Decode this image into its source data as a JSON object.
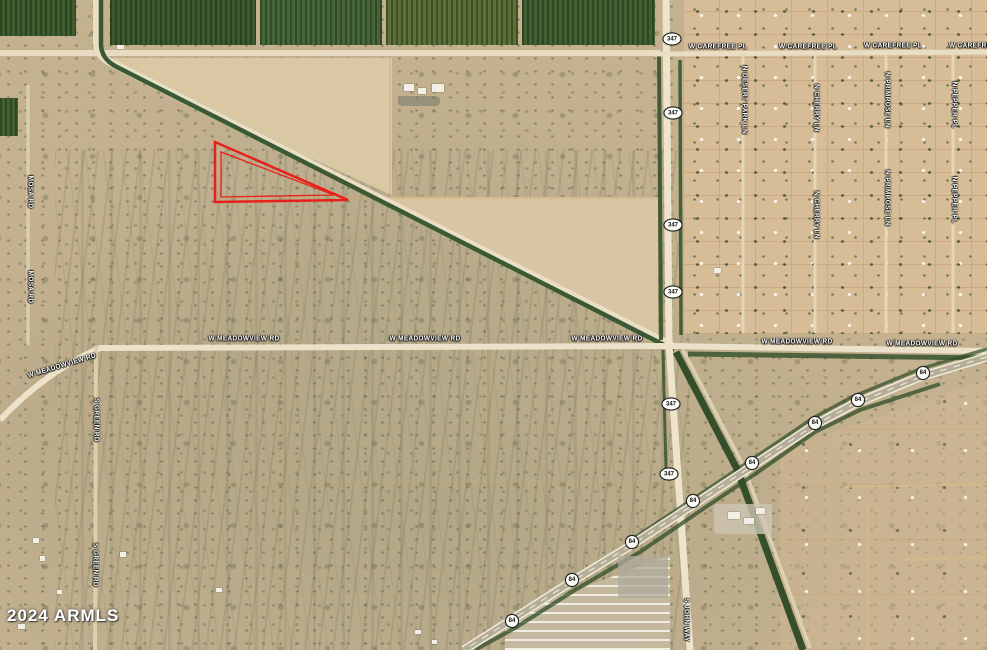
{
  "map": {
    "attribution": "2024 ARMLS",
    "accent_red": "#e8201a",
    "road_labels": [
      {
        "text": "W CAREFREE PL",
        "x": 718,
        "y": 47,
        "rot": 0
      },
      {
        "text": "W CAREFREE PL",
        "x": 808,
        "y": 47,
        "rot": 0
      },
      {
        "text": "W CAREFREE PL",
        "x": 893,
        "y": 46,
        "rot": 0
      },
      {
        "text": "W CAREFREE PL",
        "x": 978,
        "y": 46,
        "rot": 0
      },
      {
        "text": "N DESERT PARK LN",
        "x": 744,
        "y": 100,
        "rot": 90
      },
      {
        "text": "N CHERRY LN",
        "x": 816,
        "y": 108,
        "rot": 90
      },
      {
        "text": "N CHERRY LN",
        "x": 816,
        "y": 215,
        "rot": 90
      },
      {
        "text": "N PRIMROSE LN",
        "x": 887,
        "y": 100,
        "rot": 90
      },
      {
        "text": "N PRIMROSE LN",
        "x": 887,
        "y": 198,
        "rot": 90
      },
      {
        "text": "N PEPPER PL",
        "x": 954,
        "y": 105,
        "rot": 90
      },
      {
        "text": "N PEPPER PL",
        "x": 954,
        "y": 200,
        "rot": 90
      },
      {
        "text": "W MEADOWVIEW RD",
        "x": 62,
        "y": 366,
        "rot": -17
      },
      {
        "text": "W MEADOWVIEW RD",
        "x": 244,
        "y": 339,
        "rot": 0
      },
      {
        "text": "W MEADOWVIEW RD",
        "x": 425,
        "y": 339,
        "rot": 0
      },
      {
        "text": "W MEADOWVIEW RD",
        "x": 607,
        "y": 339,
        "rot": 0
      },
      {
        "text": "W MEADOWVIEW RD",
        "x": 797,
        "y": 342,
        "rot": 0
      },
      {
        "text": "W MEADOWVIEW RD",
        "x": 922,
        "y": 344,
        "rot": 0
      },
      {
        "text": "MOSA RD",
        "x": 30,
        "y": 192,
        "rot": 90
      },
      {
        "text": "MOSA RD",
        "x": 30,
        "y": 287,
        "rot": 90
      },
      {
        "text": "S GREEN RD",
        "x": 96,
        "y": 420,
        "rot": 90
      },
      {
        "text": "S GREEN RD",
        "x": 95,
        "y": 565,
        "rot": 90
      },
      {
        "text": "S JOHN WAY",
        "x": 686,
        "y": 620,
        "rot": 90
      }
    ],
    "shields": [
      {
        "num": "347",
        "x": 672,
        "y": 39
      },
      {
        "num": "347",
        "x": 673,
        "y": 113
      },
      {
        "num": "347",
        "x": 673,
        "y": 225
      },
      {
        "num": "347",
        "x": 673,
        "y": 292
      },
      {
        "num": "347",
        "x": 671,
        "y": 404
      },
      {
        "num": "347",
        "x": 669,
        "y": 474
      },
      {
        "num": "84",
        "x": 923,
        "y": 373
      },
      {
        "num": "84",
        "x": 858,
        "y": 400
      },
      {
        "num": "84",
        "x": 815,
        "y": 423
      },
      {
        "num": "84",
        "x": 752,
        "y": 463
      },
      {
        "num": "84",
        "x": 693,
        "y": 501
      },
      {
        "num": "84",
        "x": 632,
        "y": 542
      },
      {
        "num": "84",
        "x": 572,
        "y": 580
      },
      {
        "num": "84",
        "x": 512,
        "y": 621
      }
    ],
    "parcel": {
      "outer_points": "215,142 215,202 348,200",
      "inner_points": "221,152 221,197 334,195",
      "color": "#e8201a"
    }
  }
}
